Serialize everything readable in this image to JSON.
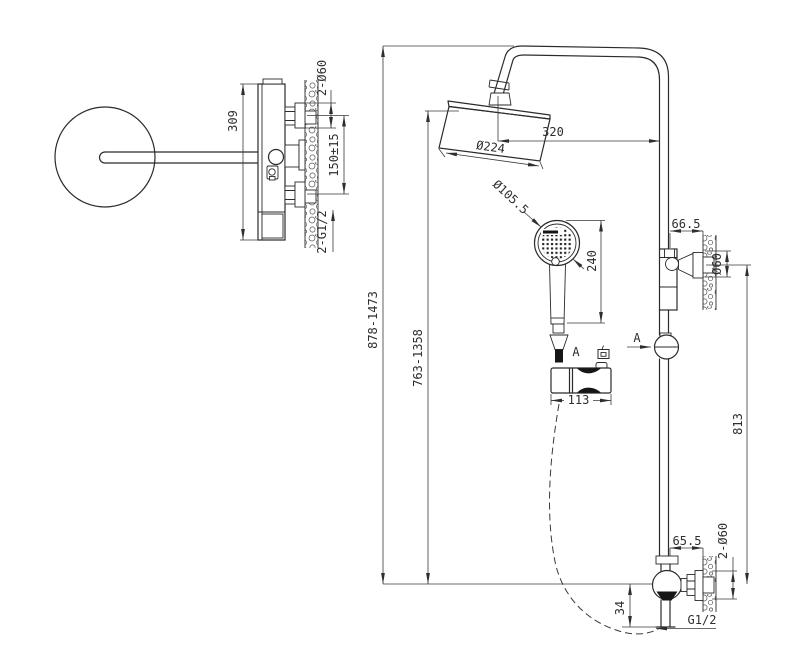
{
  "drawing": {
    "type": "technical_drawing",
    "subject": "shower column dimensional drawing",
    "colors": {
      "background": "#ffffff",
      "line": "#2b2b2b",
      "dim_text": "#2e2e2e"
    },
    "side_view": {
      "dim_body_height": "309",
      "dim_wall_holes": "2-Ø60",
      "dim_inlet_spacing": "150±15",
      "dim_inlet_thread": "2-G1/2"
    },
    "front_view": {
      "dim_arm_reach": "320",
      "dim_overhead_diameter": "Ø224",
      "dim_handshower_diameter": "Ø105.5",
      "dim_handshower_length": "240",
      "dim_overall_height_range": "878-1473",
      "dim_handshower_height_range": "763-1358",
      "dim_upper_bracket_offset": "66.5",
      "dim_upper_bracket_diameter": "Ø60",
      "dim_bracket_to_valve": "813",
      "dim_valve_offset": "65.5",
      "dim_valve_escutcheons": "2-Ø60",
      "dim_outlet_drop": "34",
      "dim_outlet_thread": "G1/2",
      "section_label": "A",
      "detail": {
        "label_a": "A",
        "label_direction": "向",
        "dim_bracket_width": "113"
      }
    }
  }
}
